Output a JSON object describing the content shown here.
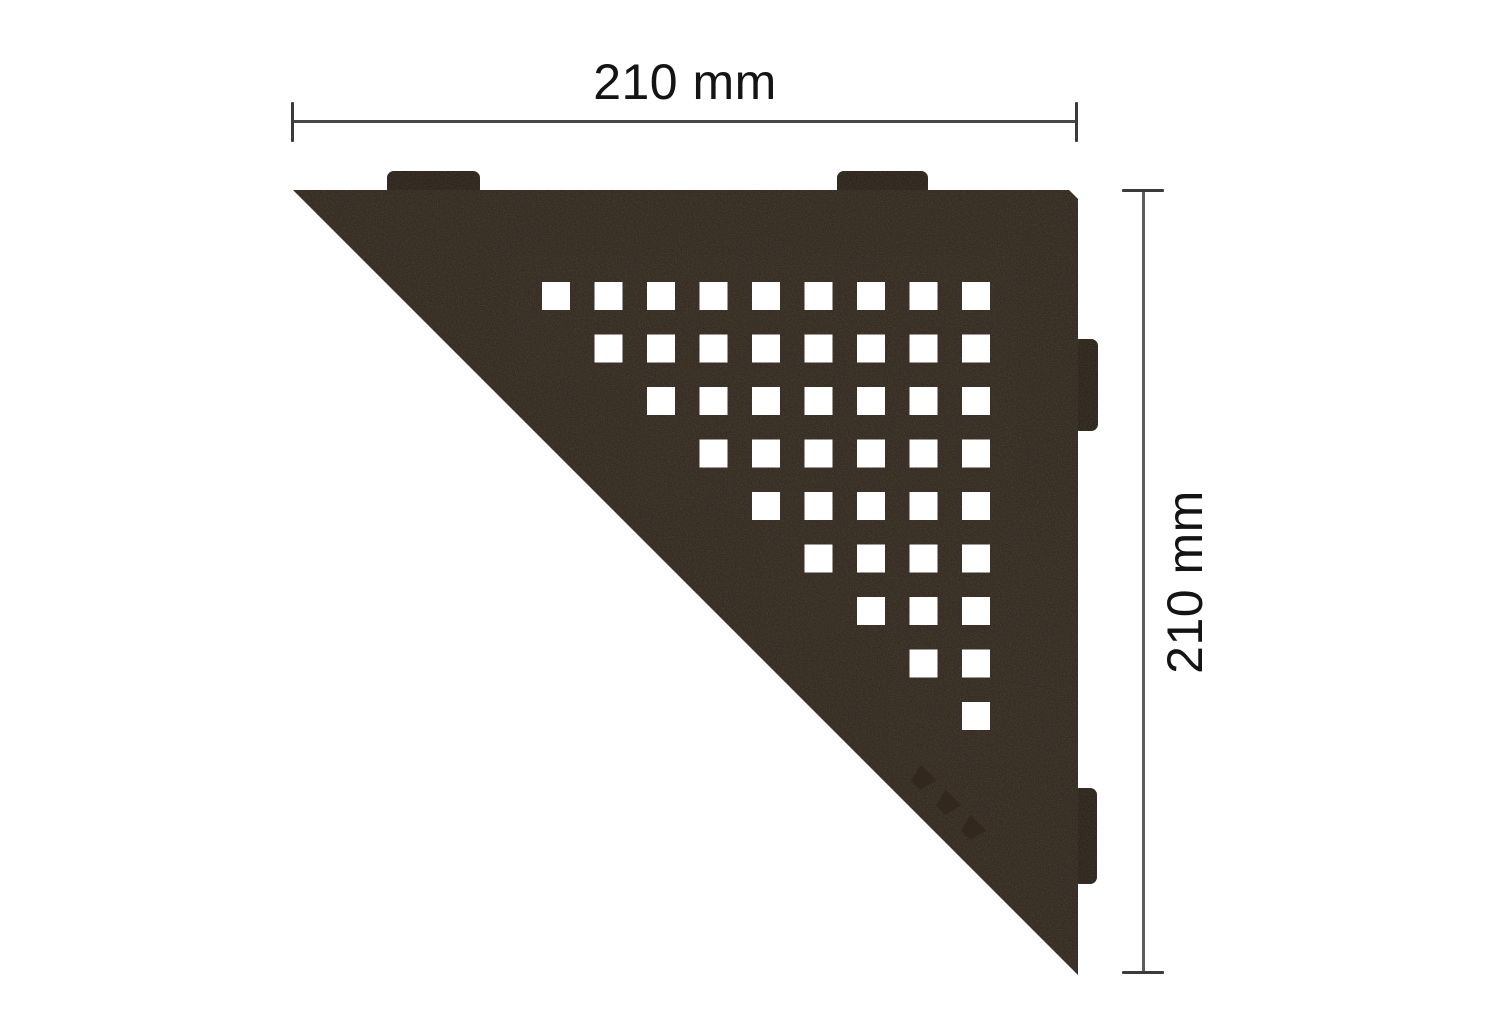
{
  "canvas": {
    "background": "#ffffff",
    "description": "Technical product drawing of a triangular corner shelf with square perforation pattern and two dimension callouts"
  },
  "dimension_top": {
    "label": "210 mm"
  },
  "dimension_right": {
    "label": "210 mm"
  },
  "shelf": {
    "shape": "right-triangle, right angle at top-right",
    "plate_color": "#4a3b2c",
    "tab_color": "#3f3225",
    "hole_color": "#ffffff",
    "logo_color": "#32271d",
    "dimension_line_color": "#47484a",
    "pattern": {
      "type": "square-perforation",
      "hole_size": 28,
      "origin_x": 542,
      "origin_y": 282,
      "pitch": 52.5,
      "total_columns": 9,
      "total_rows": 9,
      "rows": [
        {
          "start_col": 0,
          "end_col": 8
        },
        {
          "start_col": 1,
          "end_col": 8
        },
        {
          "start_col": 2,
          "end_col": 8
        },
        {
          "start_col": 3,
          "end_col": 8
        },
        {
          "start_col": 4,
          "end_col": 8
        },
        {
          "start_col": 5,
          "end_col": 8
        },
        {
          "start_col": 6,
          "end_col": 8
        },
        {
          "start_col": 7,
          "end_col": 8
        },
        {
          "start_col": 8,
          "end_col": 8
        }
      ]
    },
    "mounting_tabs": {
      "top_count": 2,
      "right_count": 2
    }
  }
}
